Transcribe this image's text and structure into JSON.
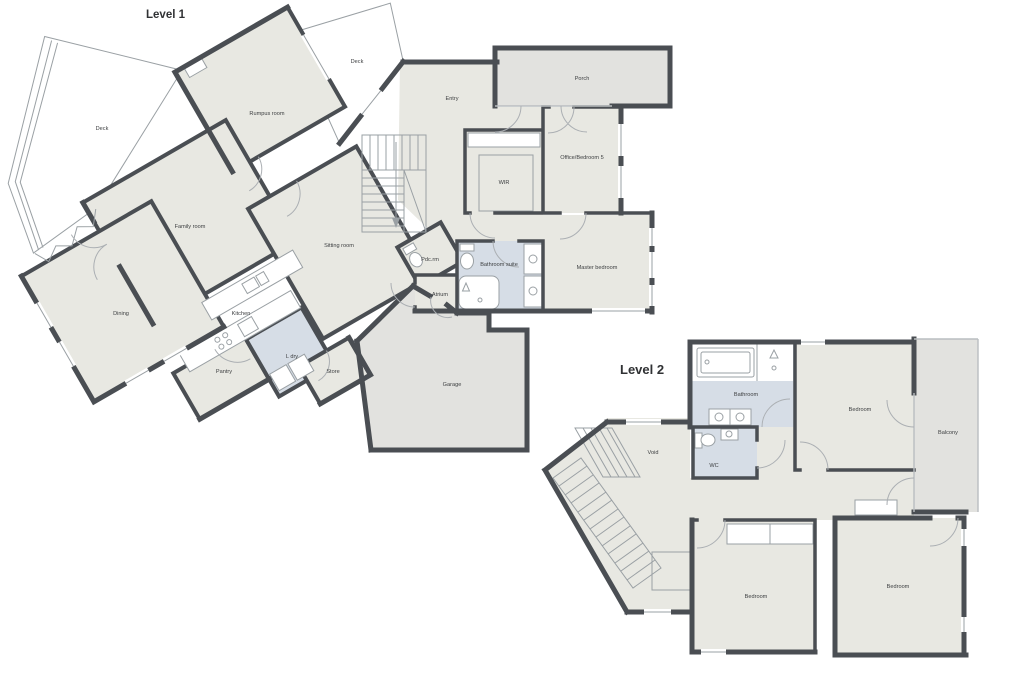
{
  "colors": {
    "wall": "#4a4e53",
    "room": "#e8e8e2",
    "outdoor": "#e2e2df",
    "wet": "#d6dde6",
    "line": "#9aa0a4",
    "label": "#3e4042",
    "title": "#303234"
  },
  "level1": {
    "title": "Level 1",
    "labels": {
      "deck_left": "Deck",
      "deck_top": "Deck",
      "rumpus": "Rumpus room",
      "family": "Family room",
      "sitting": "Sitting room",
      "dining": "Dining",
      "kitchen": "Kitchen",
      "pantry": "Pantry",
      "laundry": "L dry",
      "store": "Store",
      "entry": "Entry",
      "porch": "Porch",
      "office": "Office/Bedroom 5",
      "wir": "WIR",
      "powder": "Pdc.rm",
      "bath_suite": "Bathroom suite",
      "master": "Master bedroom",
      "atrium": "Atrium",
      "garage": "Garage"
    }
  },
  "level2": {
    "title": "Level 2",
    "labels": {
      "bathroom": "Bathroom",
      "bedroom_top": "Bedroom",
      "balcony": "Balcony",
      "void": "Void",
      "wc": "WC",
      "bedroom_left": "Bedroom",
      "bedroom_right": "Bedroom"
    }
  }
}
